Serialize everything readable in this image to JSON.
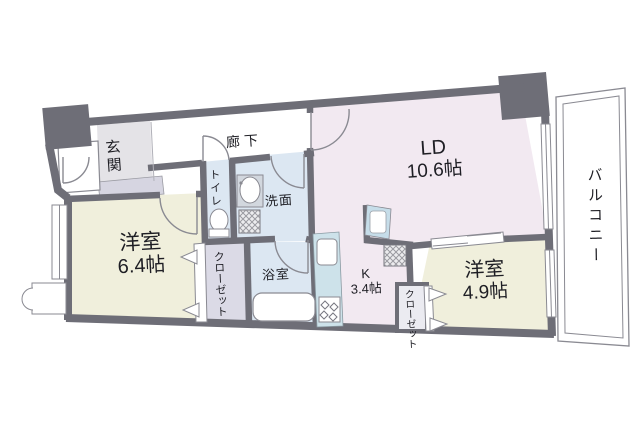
{
  "rooms": {
    "entrance": {
      "label": "玄関"
    },
    "hallway": {
      "label": "廊下"
    },
    "toilet": {
      "label": "トイレ"
    },
    "washroom": {
      "label": "洗面"
    },
    "bathroom": {
      "label": "浴室"
    },
    "closet_main": {
      "label": "クローゼット"
    },
    "closet_sub": {
      "label": "クローゼット"
    },
    "western_room_main": {
      "label": "洋室",
      "size": "6.4帖"
    },
    "western_room_sub": {
      "label": "洋室",
      "size": "4.9帖"
    },
    "living_dining": {
      "label": "LD",
      "size": "10.6帖"
    },
    "kitchen": {
      "label": "K",
      "size": "3.4帖"
    },
    "balcony": {
      "label": "バルコニー"
    }
  },
  "colors": {
    "wall": "#6e6e77",
    "living_dining_floor": "#f2e9f1",
    "western_room_floor": "#f0efdc",
    "wet_area_floor": "#dce7f2",
    "closet_floor": "#dbdae6",
    "entrance_floor": "#e4e3e7",
    "shoe_cabinet": "#d6d5e1",
    "kitchen_counter": "#cde2ea",
    "outline_thin": "#8a8a92"
  }
}
